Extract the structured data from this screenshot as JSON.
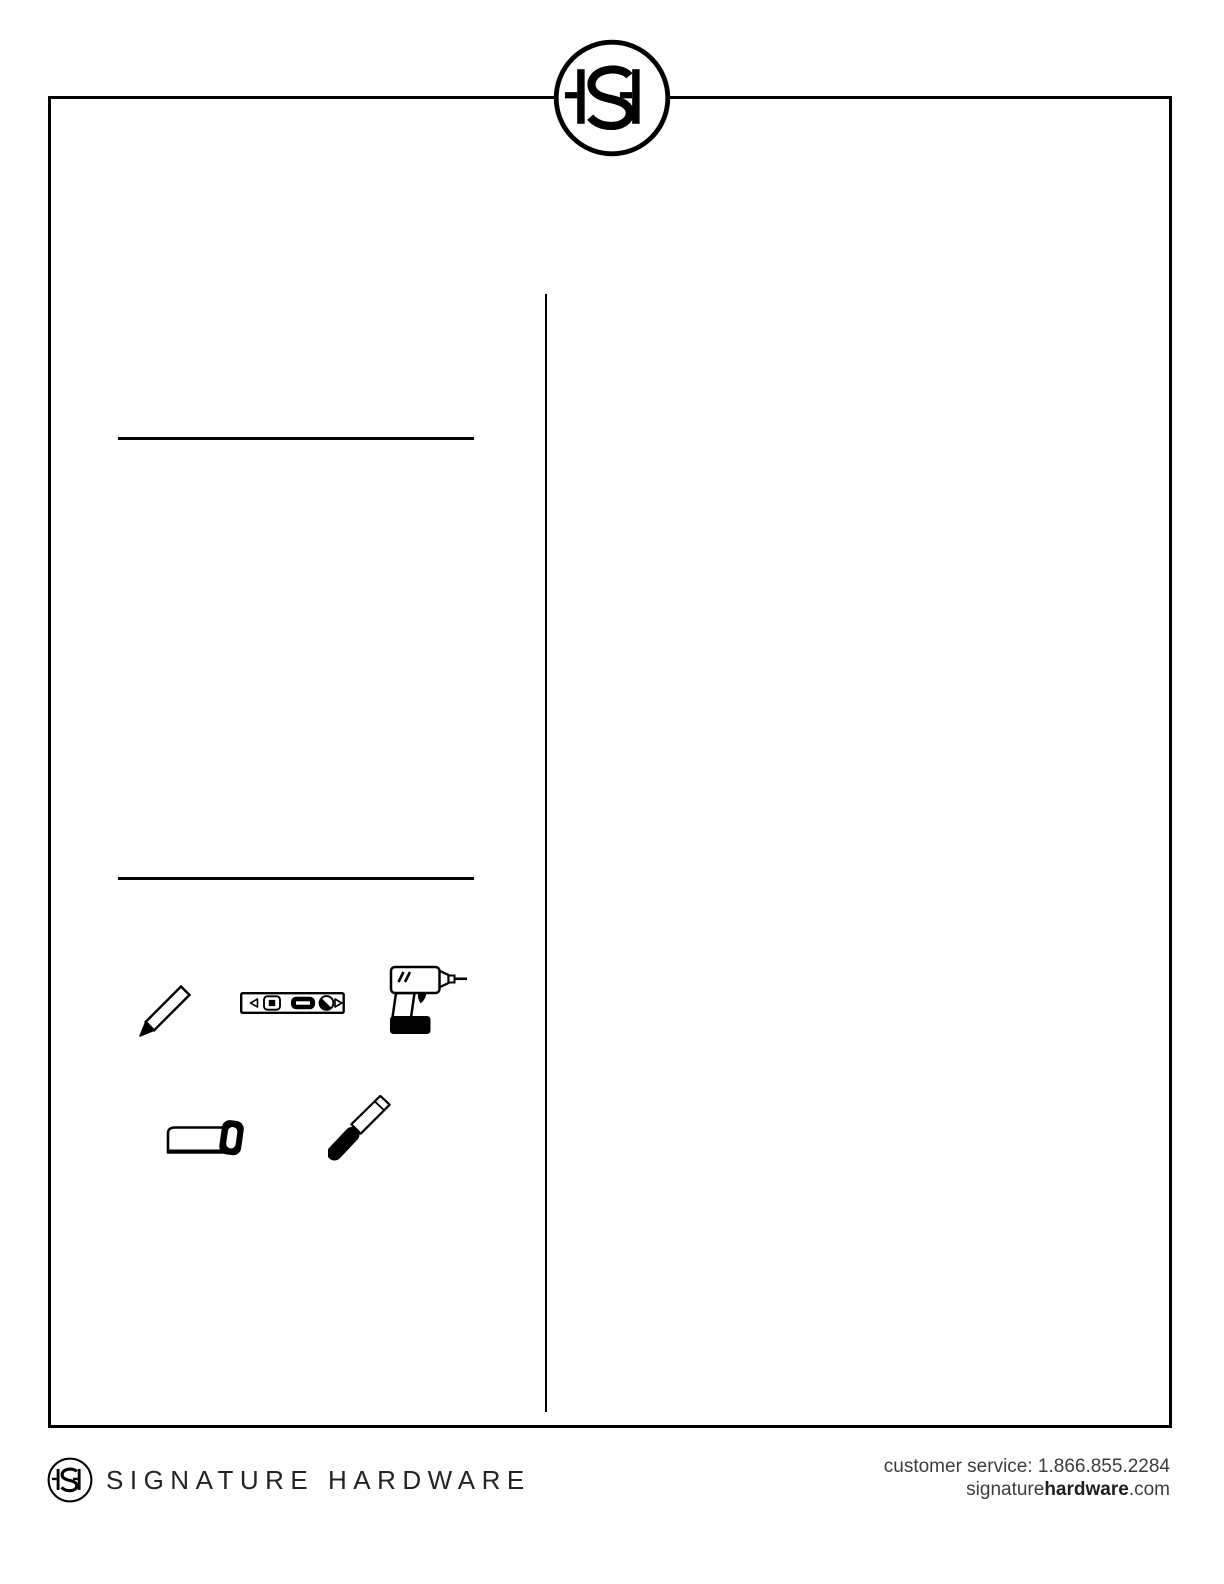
{
  "header": {
    "logo_monogram": "SH"
  },
  "tools": {
    "icons": [
      "pencil-icon",
      "level-icon",
      "drill-icon",
      "saw-icon",
      "chisel-icon"
    ]
  },
  "footer": {
    "logo_monogram": "SH",
    "brand_name": "SIGNATURE HARDWARE",
    "customer_service_label": "customer service: 1.866.855.2284",
    "website": {
      "prefix": "signature",
      "highlight": "hardware",
      "suffix": ".com"
    }
  },
  "colors": {
    "ink": "#000000",
    "footer_text": "#3d3d3d"
  }
}
